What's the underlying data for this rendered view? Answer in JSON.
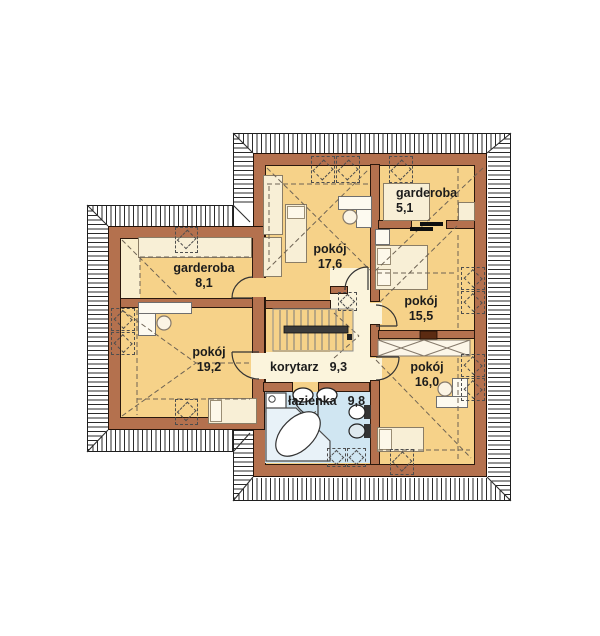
{
  "plan_type": "floor-plan-upper-storey",
  "rooms": [
    {
      "name": "pokój",
      "area": "17,6"
    },
    {
      "name": "garderoba",
      "area": "5,1"
    },
    {
      "name": "pokój",
      "area": "15,5"
    },
    {
      "name": "pokój",
      "area": "16,0"
    },
    {
      "name": "garderoba",
      "area": "8,1"
    },
    {
      "name": "pokój",
      "area": "19,2"
    },
    {
      "name": "korytarz",
      "area": "9,3"
    },
    {
      "name": "łazienka",
      "area": "9,8"
    }
  ],
  "fixtures": [
    "staircase",
    "bathtub-corner",
    "washing-machine",
    "sink",
    "sink",
    "toilet",
    "bidet",
    "bed",
    "bed",
    "bed",
    "bed",
    "desk-with-chair",
    "desk-with-chair",
    "desk-with-chair",
    "wardrobe",
    "roof-window"
  ],
  "colors": {
    "wall": "#b4714e",
    "wall_outline": "#241208",
    "room_floor": "#f6d289",
    "low_ceiling_floor": "#f9eecd",
    "corridor_floor": "#fbf4dc",
    "bathroom_floor": "#d0e6f2",
    "roof": "#ffffff",
    "roof_hatch": "#2a2a2a",
    "label_text": "#1c1c1c"
  }
}
